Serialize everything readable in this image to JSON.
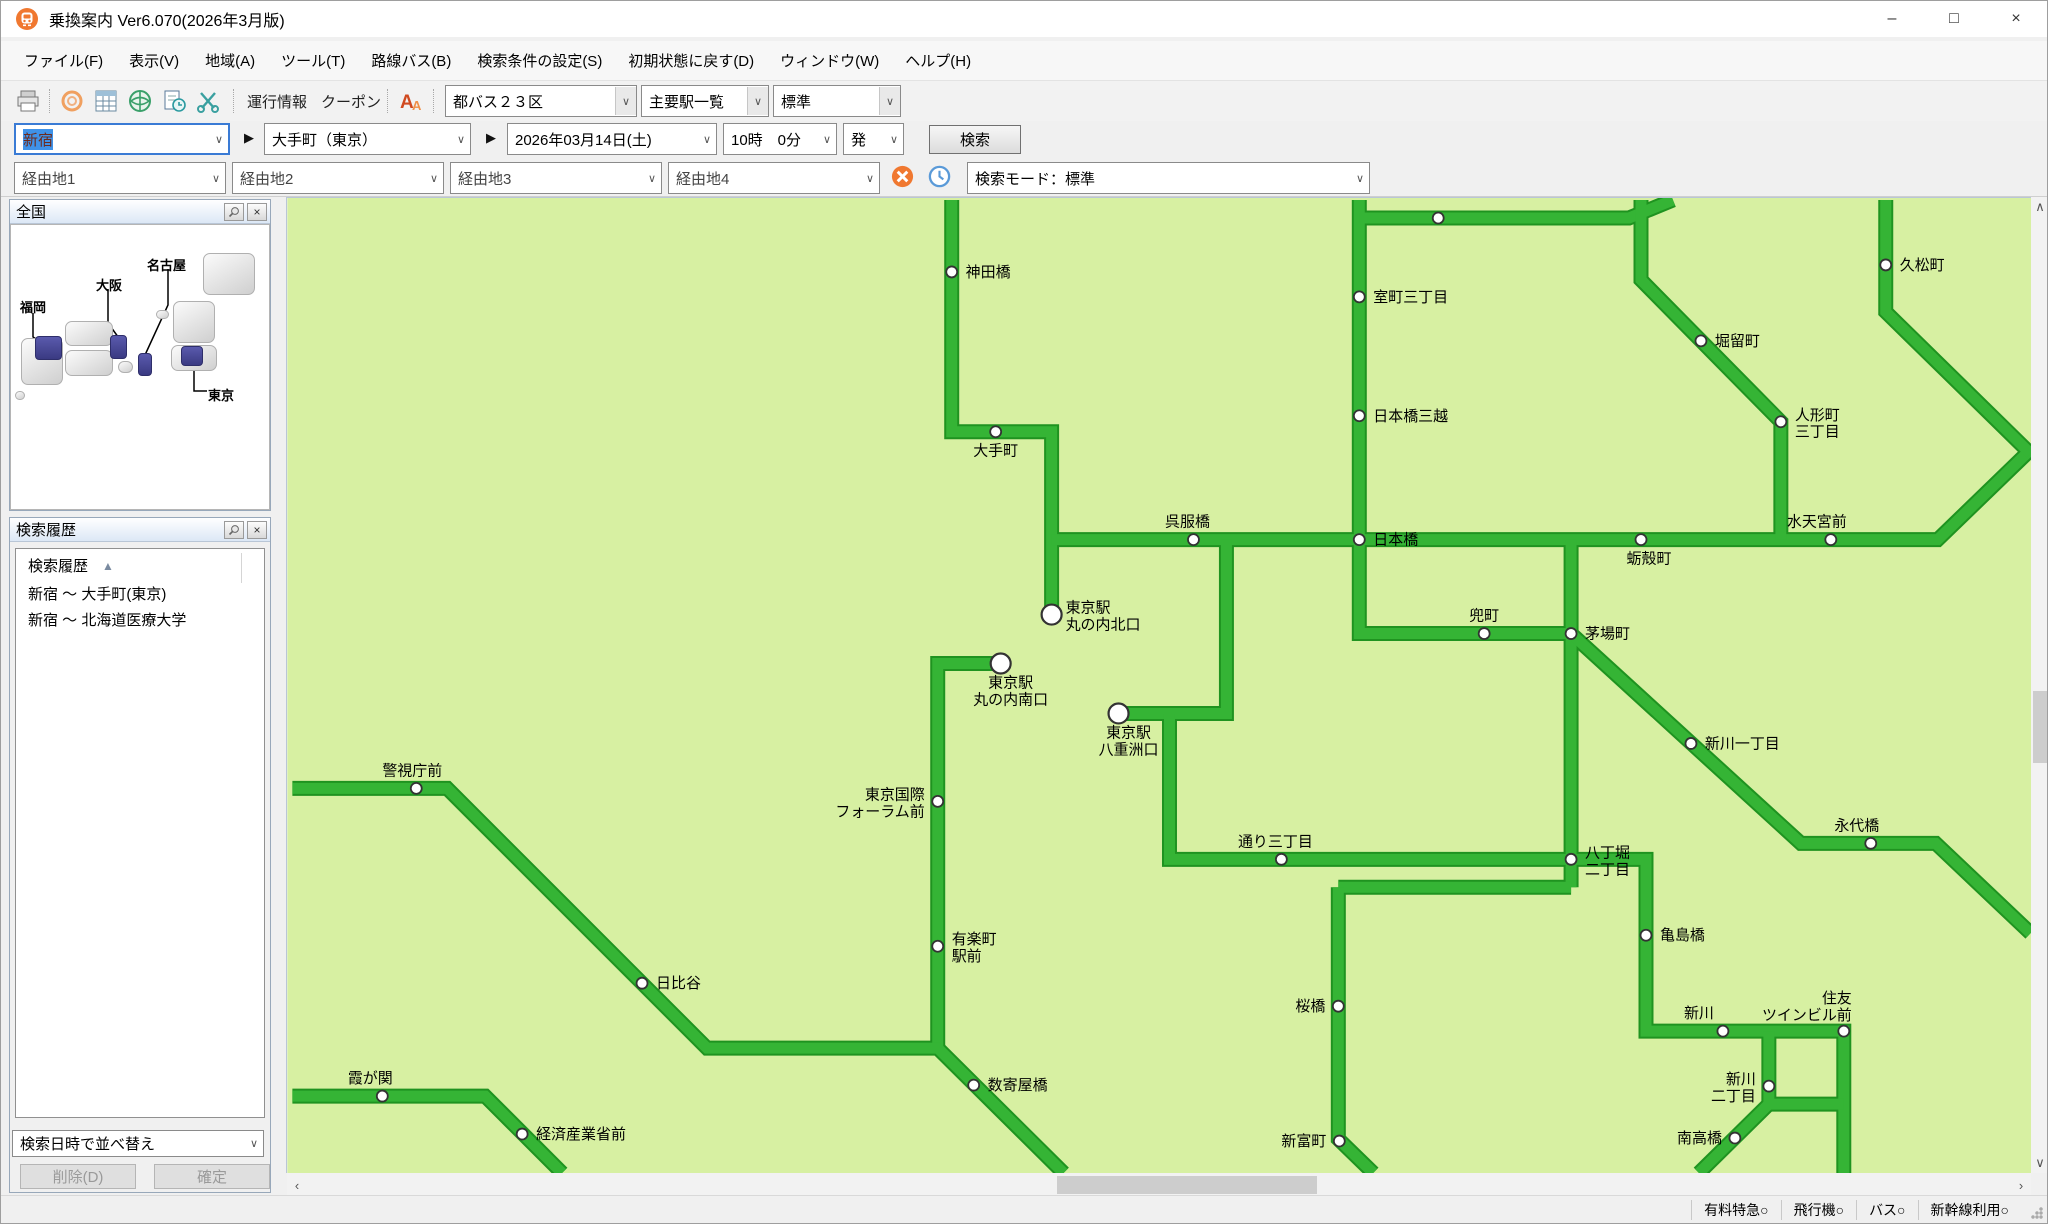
{
  "window": {
    "title": "乗換案内 Ver6.070(2026年3月版)",
    "controls": {
      "minimize": "–",
      "maximize": "□",
      "close": "×"
    }
  },
  "menu": {
    "items": [
      "ファイル(F)",
      "表示(V)",
      "地域(A)",
      "ツール(T)",
      "路線バス(B)",
      "検索条件の設定(S)",
      "初期状態に戻す(D)",
      "ウィンドウ(W)",
      "ヘルプ(H)"
    ]
  },
  "toolbar": {
    "links": [
      "運行情報",
      "クーポン"
    ],
    "dropdowns": [
      "都バス２３区",
      "主要駅一覧",
      "標準"
    ]
  },
  "search": {
    "from": "新宿",
    "to": "大手町（東京）",
    "date": "2026年03月14日(土)",
    "time": "10時　0分",
    "depart": "発",
    "button": "検索"
  },
  "via": {
    "fields": [
      "経由地1",
      "経由地2",
      "経由地3",
      "経由地4"
    ],
    "mode": "検索モード：標準"
  },
  "zenkoku": {
    "title": "全国",
    "labels": [
      {
        "text": "福岡",
        "x": 9,
        "y": 72
      },
      {
        "text": "大阪",
        "x": 85,
        "y": 50
      },
      {
        "text": "名古屋",
        "x": 136,
        "y": 30
      },
      {
        "text": "東京",
        "x": 197,
        "y": 160
      }
    ],
    "grey_blocks": [
      [
        10,
        113,
        42,
        47
      ],
      [
        54,
        96,
        48,
        25
      ],
      [
        54,
        125,
        48,
        26
      ],
      [
        107,
        136,
        15,
        12
      ],
      [
        162,
        76,
        42,
        42
      ],
      [
        160,
        120,
        46,
        26
      ],
      [
        192,
        28,
        52,
        42
      ],
      [
        145,
        85,
        13,
        9
      ],
      [
        4,
        166,
        10,
        9
      ]
    ],
    "blue_blocks": [
      [
        24,
        111,
        27,
        24
      ],
      [
        99,
        110,
        17,
        24
      ],
      [
        127,
        128,
        14,
        23
      ],
      [
        170,
        121,
        22,
        20
      ]
    ],
    "connectors": [
      [
        [
          22,
          88
        ],
        [
          22,
          112
        ],
        [
          38,
          122
        ]
      ],
      [
        [
          97,
          64
        ],
        [
          97,
          98
        ],
        [
          110,
          116
        ]
      ],
      [
        [
          157,
          44
        ],
        [
          157,
          80
        ],
        [
          134,
          130
        ]
      ],
      [
        [
          196,
          166
        ],
        [
          183,
          166
        ],
        [
          183,
          142
        ]
      ]
    ]
  },
  "history": {
    "title": "検索履歴",
    "column_header": "検索履歴",
    "sort_indicator": "▲",
    "rows": [
      "新宿 ～ 大手町(東京)",
      "新宿 ～ 北海道医療大学"
    ],
    "sort_dropdown": "検索日時で並べ替え",
    "delete_button": "削除(D)",
    "confirm_button": "確定"
  },
  "statusbar": {
    "items": [
      "有料特急○",
      "飛行機○",
      "バス○",
      "新幹線利用○"
    ]
  },
  "map": {
    "bg": "#d7f0a2",
    "line_edge": "#1f9320",
    "line_fill": "#35b435",
    "dot_stroke": "#333333",
    "lines": [
      [
        [
          950,
          198
        ],
        [
          950,
          430
        ],
        [
          1050,
          430
        ],
        [
          1050,
          613
        ]
      ],
      [
        [
          1050,
          538
        ],
        [
          1937,
          538
        ],
        [
          2030,
          448
        ]
      ],
      [
        [
          1358,
          198
        ],
        [
          1358,
          632
        ],
        [
          1570,
          632
        ]
      ],
      [
        [
          1358,
          216
        ],
        [
          1628,
          216
        ],
        [
          1672,
          198
        ]
      ],
      [
        [
          1885,
          198
        ],
        [
          1885,
          310
        ],
        [
          2030,
          452
        ]
      ],
      [
        [
          1640,
          198
        ],
        [
          1640,
          278
        ],
        [
          1780,
          420
        ],
        [
          1780,
          538
        ]
      ],
      [
        [
          1570,
          538
        ],
        [
          1570,
          886
        ]
      ],
      [
        [
          1225,
          538
        ],
        [
          1225,
          712
        ],
        [
          1117,
          712
        ]
      ],
      [
        [
          1168,
          712
        ],
        [
          1168,
          858
        ],
        [
          1573,
          858
        ]
      ],
      [
        [
          999,
          662
        ],
        [
          936,
          662
        ],
        [
          936,
          1050
        ]
      ],
      [
        [
          290,
          787
        ],
        [
          445,
          787
        ],
        [
          705,
          1047
        ],
        [
          936,
          1047
        ],
        [
          1062,
          1172
        ]
      ],
      [
        [
          290,
          1095
        ],
        [
          483,
          1095
        ],
        [
          560,
          1172
        ]
      ],
      [
        [
          1570,
          632
        ],
        [
          1800,
          842
        ],
        [
          1935,
          842
        ],
        [
          2030,
          932
        ]
      ],
      [
        [
          1337,
          886
        ],
        [
          1570,
          886
        ]
      ],
      [
        [
          1337,
          886
        ],
        [
          1337,
          1138
        ],
        [
          1372,
          1172
        ]
      ],
      [
        [
          1573,
          858
        ],
        [
          1645,
          858
        ],
        [
          1645,
          1030
        ],
        [
          1843,
          1030
        ],
        [
          1843,
          1172
        ]
      ],
      [
        [
          1768,
          1030
        ],
        [
          1768,
          1103
        ],
        [
          1843,
          1103
        ]
      ],
      [
        [
          1768,
          1103
        ],
        [
          1698,
          1172
        ]
      ]
    ],
    "stations": [
      {
        "x": 950,
        "y": 270,
        "label": "神田橋",
        "pos": "r"
      },
      {
        "x": 1437,
        "y": 216,
        "label": "",
        "pos": "r"
      },
      {
        "x": 1358,
        "y": 295,
        "label": "室町三丁目",
        "pos": "r"
      },
      {
        "x": 1885,
        "y": 263,
        "label": "久松町",
        "pos": "r"
      },
      {
        "x": 1700,
        "y": 339,
        "label": "堀留町",
        "pos": "r"
      },
      {
        "x": 1780,
        "y": 420,
        "label": [
          "人形町",
          "三丁目"
        ],
        "pos": "r"
      },
      {
        "x": 994,
        "y": 430,
        "label": "大手町",
        "pos": "b"
      },
      {
        "x": 1358,
        "y": 414,
        "label": "日本橋三越",
        "pos": "r"
      },
      {
        "x": 1830,
        "y": 538,
        "label": "水天宮前",
        "pos": "a",
        "dx": -14
      },
      {
        "x": 1192,
        "y": 538,
        "label": "呉服橋",
        "pos": "a",
        "dx": -6
      },
      {
        "x": 1358,
        "y": 538,
        "label": "日本橋",
        "pos": "r"
      },
      {
        "x": 1640,
        "y": 538,
        "label": "蛎殻町",
        "pos": "b",
        "dx": 8
      },
      {
        "x": 1050,
        "y": 613,
        "label": [
          "東京駅",
          "丸の内北口"
        ],
        "pos": "r",
        "big": true
      },
      {
        "x": 1483,
        "y": 632,
        "label": "兜町",
        "pos": "a"
      },
      {
        "x": 1570,
        "y": 632,
        "label": "茅場町",
        "pos": "r"
      },
      {
        "x": 999,
        "y": 662,
        "label": [
          "東京駅",
          "丸の内南口"
        ],
        "pos": "b",
        "big": true,
        "dx": 10
      },
      {
        "x": 1117,
        "y": 712,
        "label": [
          "東京駅",
          "八重洲口"
        ],
        "pos": "b",
        "big": true,
        "dx": 10
      },
      {
        "x": 1690,
        "y": 742,
        "label": "新川一丁目",
        "pos": "r"
      },
      {
        "x": 414,
        "y": 787,
        "label": "警視庁前",
        "pos": "a",
        "dx": -4
      },
      {
        "x": 936,
        "y": 800,
        "label": [
          "東京国際",
          "フォーラム前"
        ],
        "pos": "l"
      },
      {
        "x": 1280,
        "y": 858,
        "label": "通り三丁目",
        "pos": "a",
        "dx": -6
      },
      {
        "x": 1870,
        "y": 842,
        "label": "永代橋",
        "pos": "a",
        "dx": -14
      },
      {
        "x": 1570,
        "y": 858,
        "label": [
          "八丁堀",
          "二丁目"
        ],
        "pos": "r"
      },
      {
        "x": 936,
        "y": 945,
        "label": [
          "有楽町",
          "駅前"
        ],
        "pos": "r"
      },
      {
        "x": 640,
        "y": 982,
        "label": "日比谷",
        "pos": "r"
      },
      {
        "x": 1645,
        "y": 934,
        "label": "亀島橋",
        "pos": "r"
      },
      {
        "x": 1337,
        "y": 1005,
        "label": "桜橋",
        "pos": "l"
      },
      {
        "x": 1843,
        "y": 1030,
        "label": [
          "住友",
          "ツインビル前"
        ],
        "pos": "la"
      },
      {
        "x": 1722,
        "y": 1030,
        "label": "新川",
        "pos": "a",
        "dx": -24
      },
      {
        "x": 380,
        "y": 1095,
        "label": "霞が関",
        "pos": "a",
        "dx": -12
      },
      {
        "x": 972,
        "y": 1084,
        "label": "数寄屋橋",
        "pos": "r"
      },
      {
        "x": 1768,
        "y": 1085,
        "label": [
          "新川",
          "二丁目"
        ],
        "pos": "l"
      },
      {
        "x": 520,
        "y": 1133,
        "label": "経済産業省前",
        "pos": "r"
      },
      {
        "x": 1734,
        "y": 1137,
        "label": "南高橋",
        "pos": "l"
      },
      {
        "x": 1338,
        "y": 1140,
        "label": "新富町",
        "pos": "l"
      }
    ]
  }
}
